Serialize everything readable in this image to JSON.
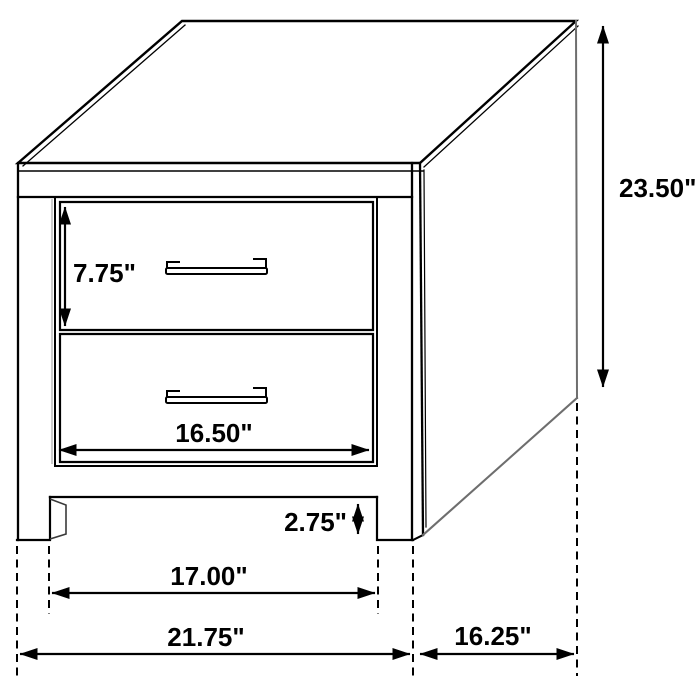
{
  "diagram": {
    "item": "2-drawer-nightstand",
    "unit": "inches",
    "colors": {
      "background": "#ffffff",
      "line": "#000000",
      "muted_line": "#6e6e6e",
      "shadow_line": "#b6b6b6",
      "hint_line": "#3a3a3a"
    },
    "labels": {
      "overall_height": "23.50\"",
      "drawer_front_height": "7.75\"",
      "drawer_width": "16.50\"",
      "base_clearance": "2.75\"",
      "leg_span": "17.00\"",
      "overall_width": "21.75\"",
      "overall_depth": "16.25\""
    }
  }
}
